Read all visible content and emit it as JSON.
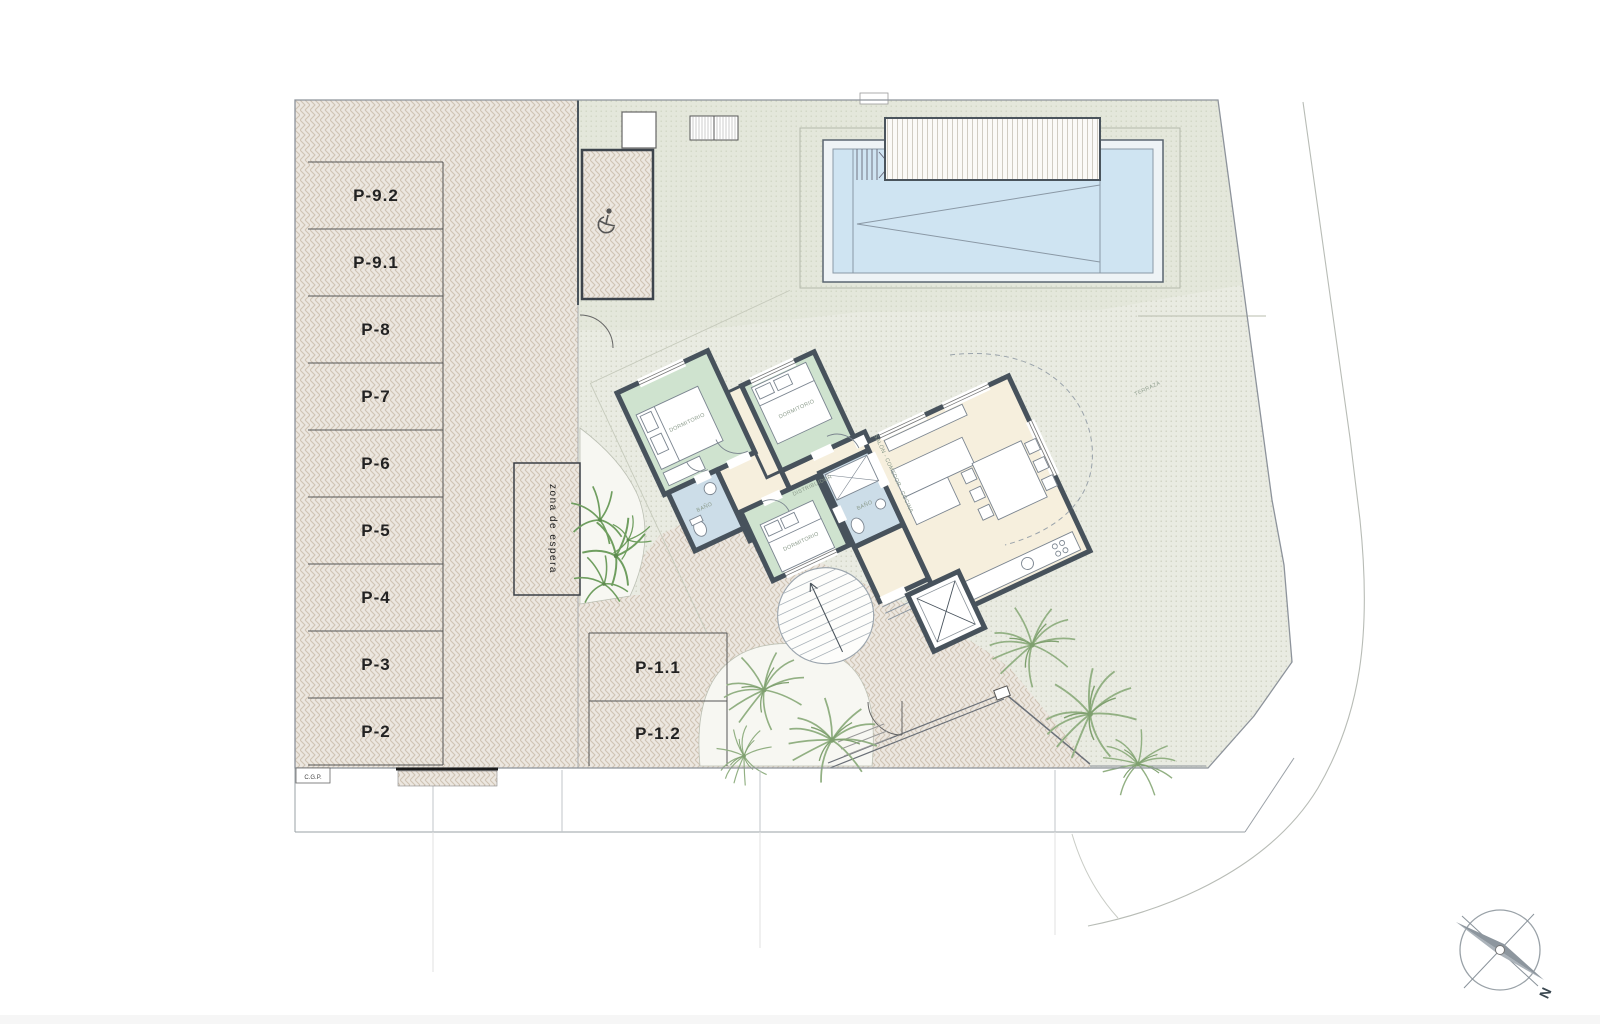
{
  "plan": {
    "parking": {
      "stalls": [
        {
          "label": "P-9.2"
        },
        {
          "label": "P-9.1"
        },
        {
          "label": "P-8"
        },
        {
          "label": "P-7"
        },
        {
          "label": "P-6"
        },
        {
          "label": "P-5"
        },
        {
          "label": "P-4"
        },
        {
          "label": "P-3"
        },
        {
          "label": "P-2"
        }
      ],
      "front_stalls": [
        {
          "label": "P-1.1"
        },
        {
          "label": "P-1.2"
        }
      ],
      "waiting_area_label": "zona de espera",
      "utility_box_label": "C.G.P."
    },
    "rooms": {
      "bedroom1": "DORMITORIO",
      "bedroom2": "DORMITORIO",
      "bedroom3": "DORMITORIO",
      "bath1": "BAÑO",
      "bath2": "BAÑO",
      "hall": "DISTRIBUIDOR",
      "living": "SALÓN - COMEDOR - COCINA",
      "terrace": "TERRAZA"
    },
    "compass": {
      "north": "N"
    },
    "colors": {
      "paving": "#ece7e0",
      "paving_stroke": "#cfc3b3",
      "terrace_dots": "#e9ebe2",
      "pool_water": "#cfe4f2",
      "bedroom": "#cfe3cf",
      "bath": "#ccdde8",
      "living": "#f6efdd",
      "wall": "#47525c"
    }
  }
}
